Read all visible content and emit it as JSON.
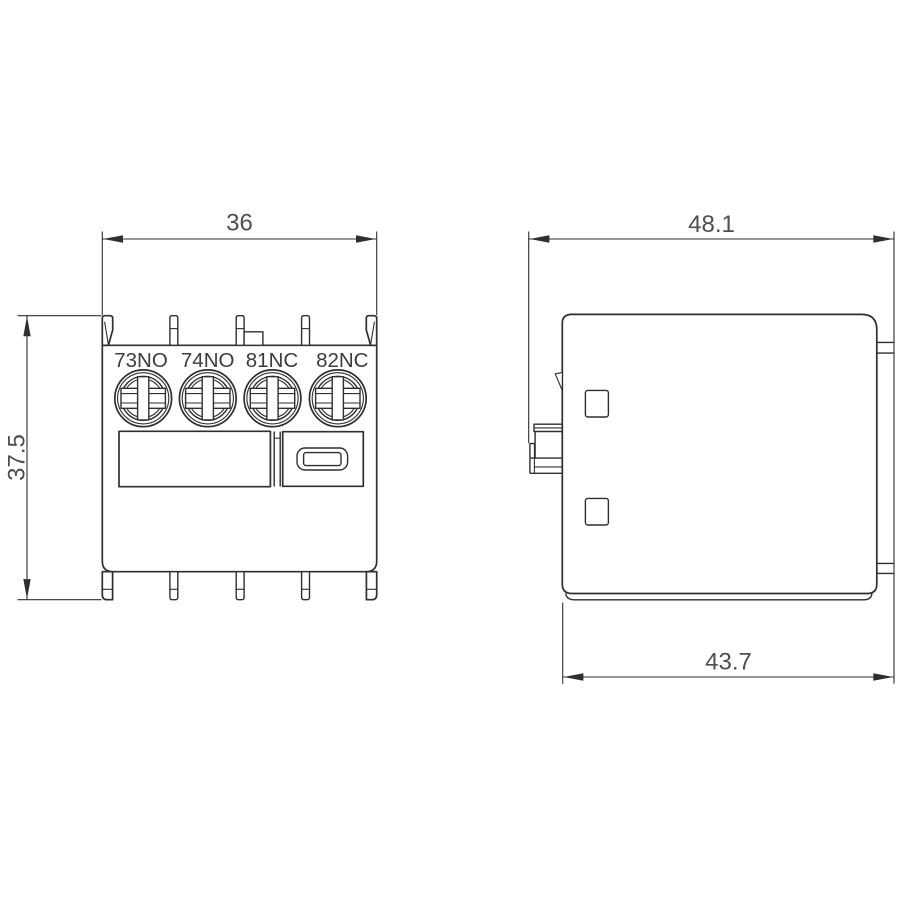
{
  "dimensions": {
    "front_width": "36",
    "front_height": "37.5",
    "side_width": "48.1",
    "side_depth": "43.7"
  },
  "terminal_labels": [
    "73NO",
    "74NO",
    "81NC",
    "82NC"
  ],
  "colors": {
    "line": "#2f2f2f",
    "dimension_text": "#4f4f4f",
    "terminal_text": "#3c3c3c",
    "background": "#ffffff"
  }
}
